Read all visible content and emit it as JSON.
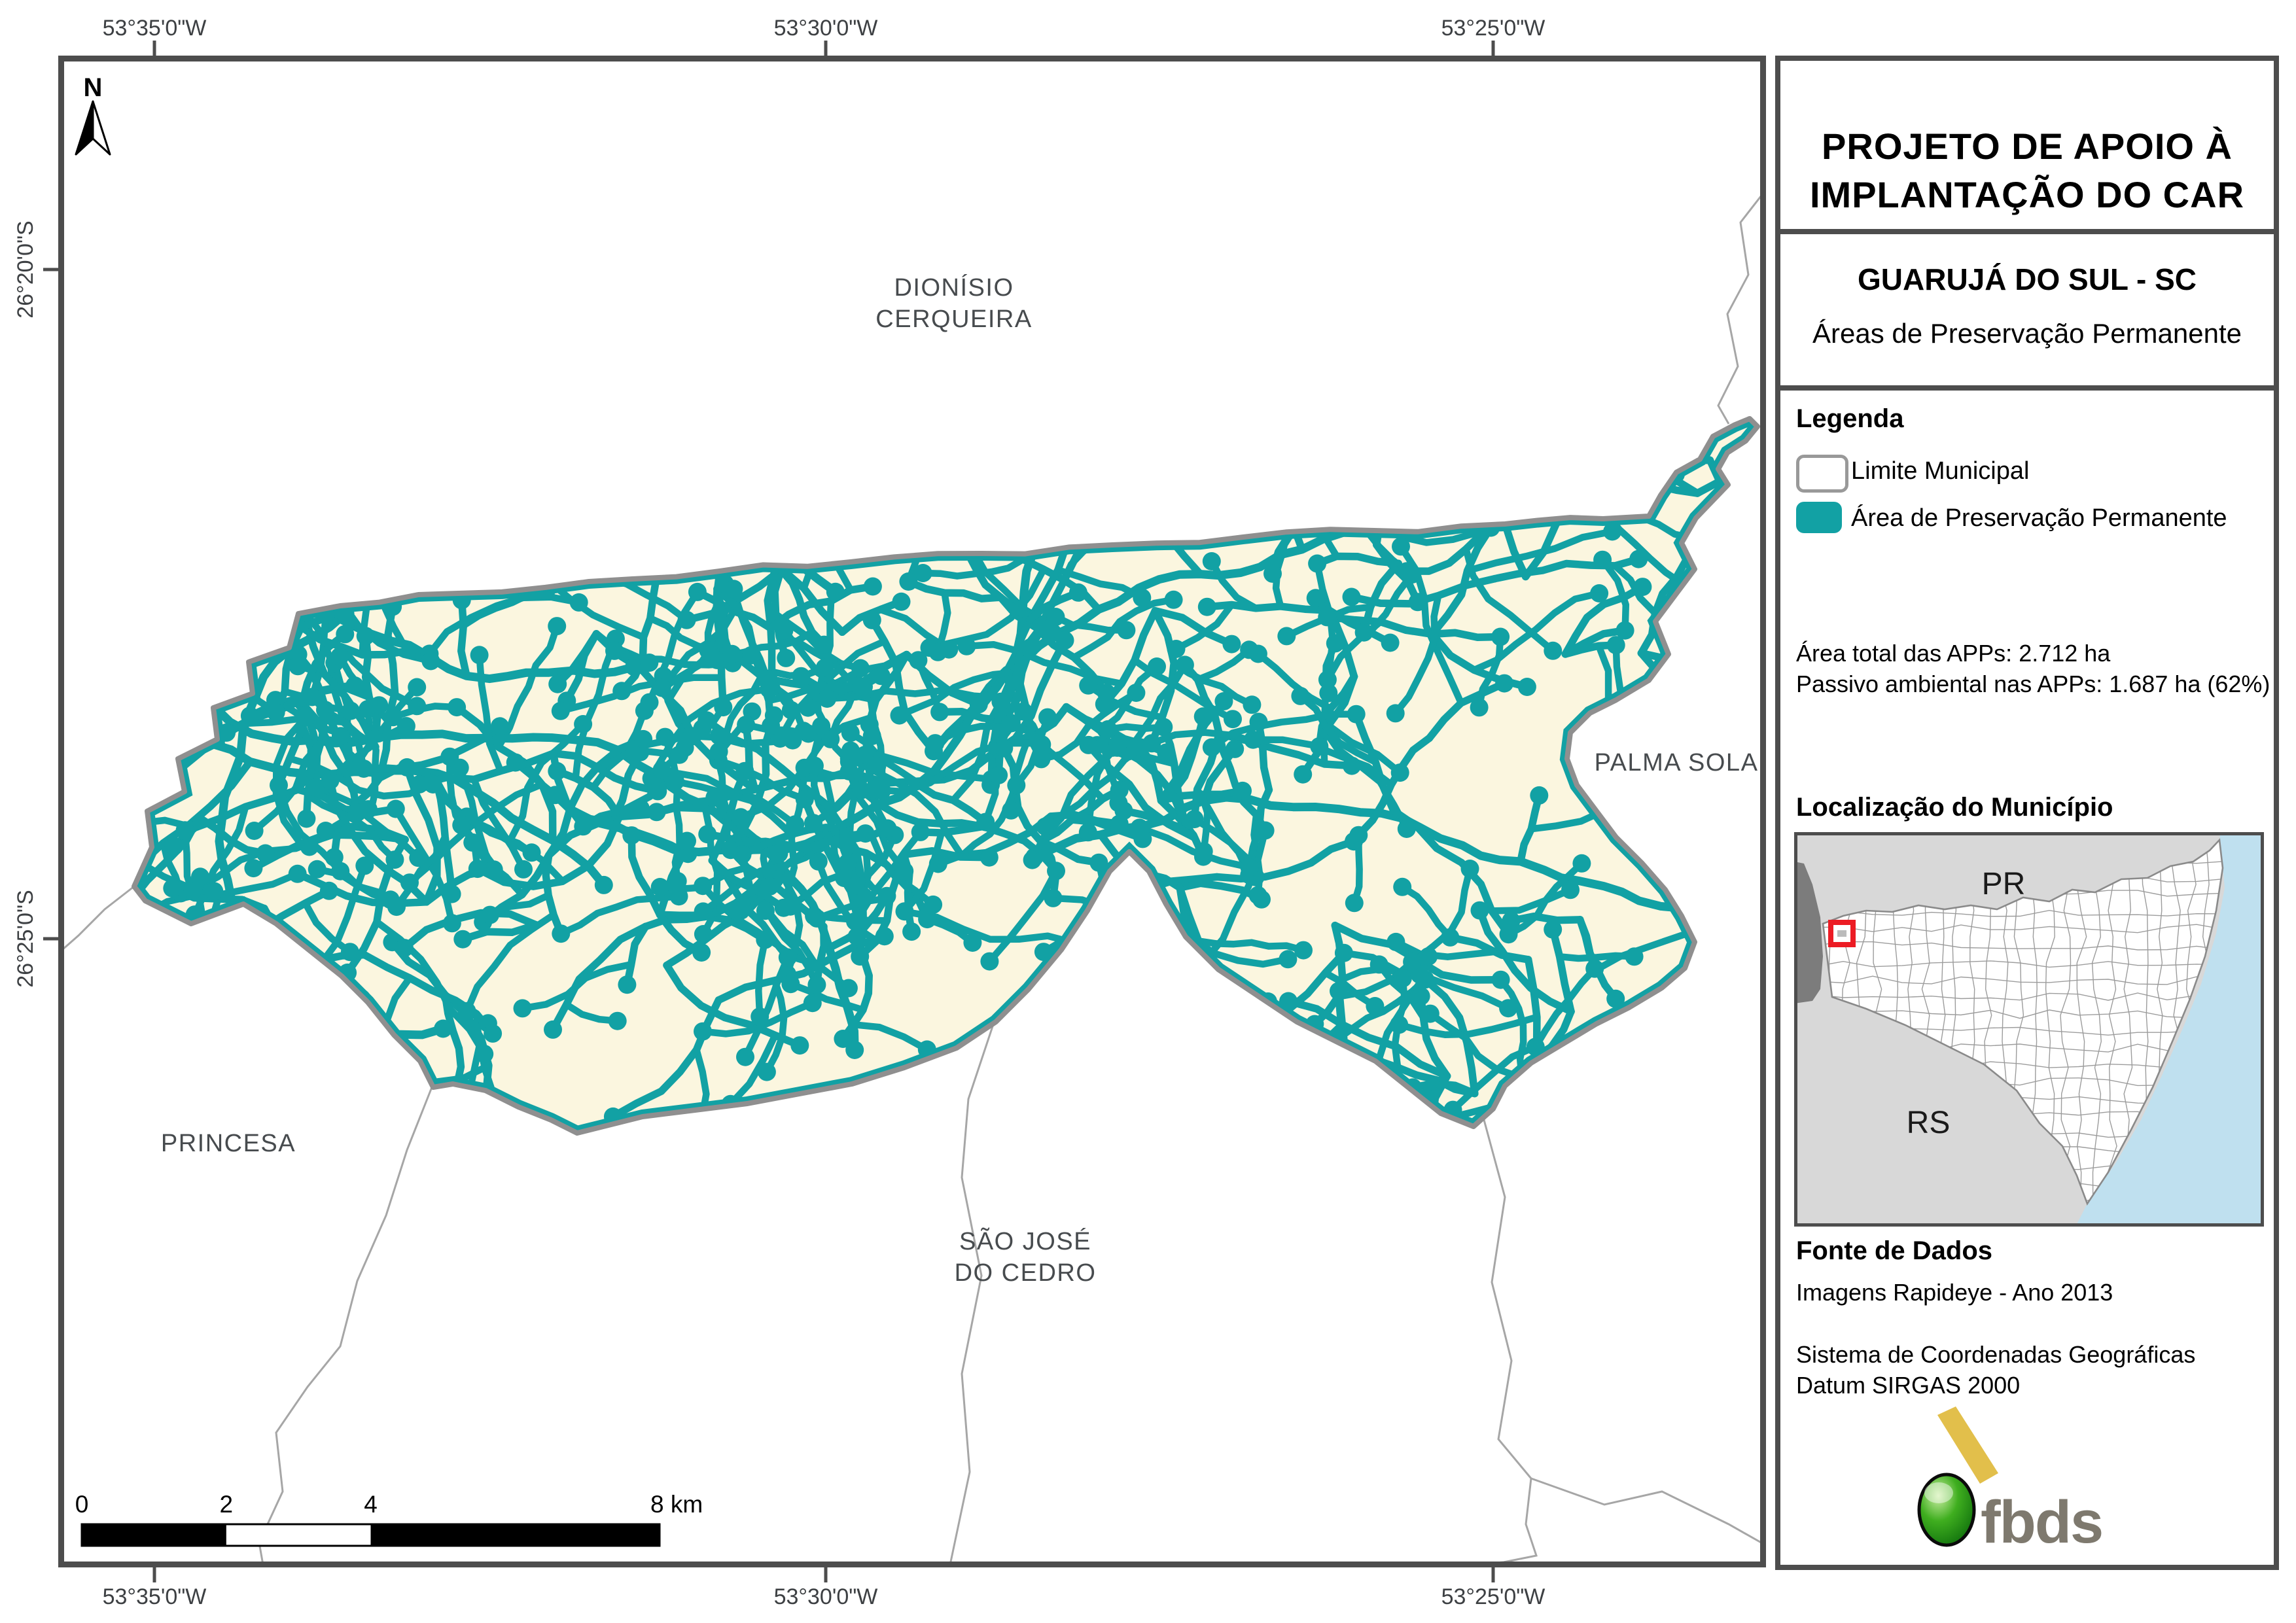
{
  "header": {
    "title_line1": "PROJETO DE APOIO À",
    "title_line2": "IMPLANTAÇÃO DO CAR",
    "municipality": "GUARUJÁ DO SUL - SC",
    "subtitle": "Áreas de Preservação Permanente"
  },
  "legend": {
    "title": "Legenda",
    "items": [
      {
        "label": "Limite Municipal",
        "type": "outline"
      },
      {
        "label": "Área de Preservação Permanente",
        "type": "fill"
      }
    ]
  },
  "stats": {
    "line1": "Área total das APPs: 2.712 ha",
    "line2": "Passivo ambiental nas APPs: 1.687 ha (62%)"
  },
  "location": {
    "title": "Localização do Município",
    "label_pr": "PR",
    "label_rs": "RS"
  },
  "source": {
    "title": "Fonte de Dados",
    "line1": "Imagens Rapideye - Ano 2013",
    "line2": "Sistema de Coordenadas Geográficas",
    "line3": "Datum SIRGAS 2000"
  },
  "logo": {
    "text": "fbds"
  },
  "map": {
    "north_label": "N",
    "labels": [
      {
        "id": "dionisio-cerqueira",
        "lines": [
          "DIONÍSIO",
          "CERQUEIRA"
        ]
      },
      {
        "id": "palma-sola",
        "lines": [
          "PALMA SOLA"
        ]
      },
      {
        "id": "princesa",
        "lines": [
          "PRINCESA"
        ]
      },
      {
        "id": "sao-jose-do-cedro",
        "lines": [
          "SÃO JOSÉ",
          "DO CEDRO"
        ]
      }
    ],
    "graticule": {
      "top": [
        "53°35'0\"W",
        "53°30'0\"W",
        "53°25'0\"W"
      ],
      "bottom": [
        "53°35'0\"W",
        "53°30'0\"W",
        "53°25'0\"W"
      ],
      "left": [
        "26°20'0\"S",
        "26°25'0\"S"
      ]
    },
    "scalebar": {
      "labels": [
        "0",
        "2",
        "4",
        "8 km"
      ]
    }
  },
  "colors": {
    "app_teal": "#12A1A4",
    "municipality_fill": "#FBF6DF",
    "municipality_border": "#8F8F8F",
    "neighbor_line": "#A6A6A6",
    "frame": "#4D4D4D",
    "coord_text": "#3D4043",
    "map_label": "#474B4E",
    "scalebar_black": "#000000",
    "inset_land": "#D8D8D8",
    "inset_foreign": "#7C7C7C",
    "inset_ocean": "#BFE0EF",
    "inset_cells": "#9C9C9C",
    "inset_sc_fill": "#FFFFFF",
    "inset_sc_border": "#8A8A8A",
    "marker_red": "#EC1C24",
    "logo_green_hi": "#CDEFA5",
    "logo_green": "#3FAE1F",
    "logo_green_dk": "#0E6E0C",
    "logo_yellow": "#E2BF4B",
    "logo_text": "#7E796E"
  }
}
